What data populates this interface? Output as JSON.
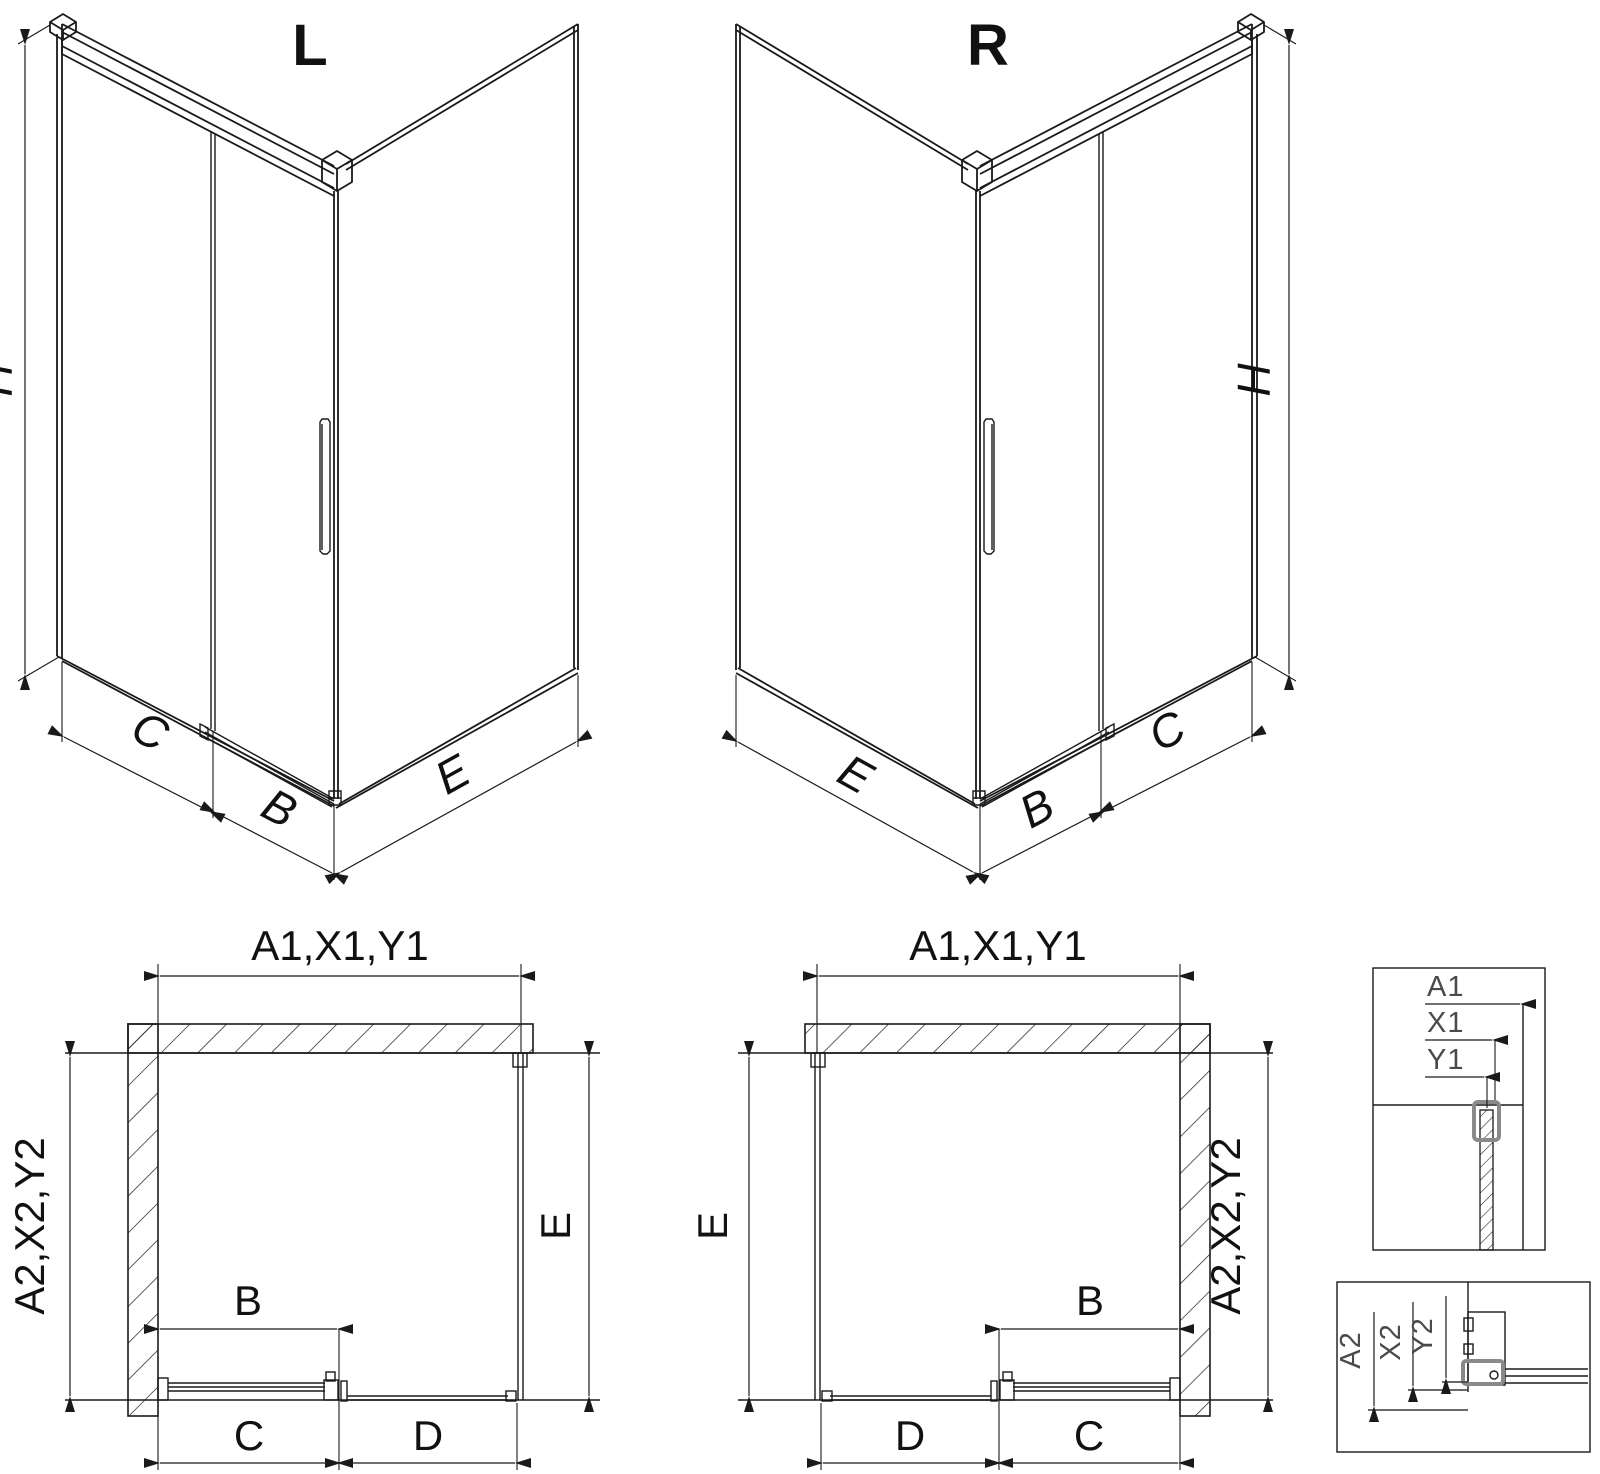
{
  "drawing": {
    "type": "shower-enclosure-technical-drawing",
    "background_color": "#ffffff",
    "line_color": "#1a1a1a",
    "detail_text_color": "#4a4a4a",
    "clamp_highlight_color": "#8a8a8a"
  },
  "iso_left": {
    "title": "L",
    "dim_height": "H",
    "dim_fixed_panel": "C",
    "dim_door": "B",
    "dim_return_panel": "E"
  },
  "iso_right": {
    "title": "R",
    "dim_height": "H",
    "dim_fixed_panel": "C",
    "dim_door": "B",
    "dim_return_panel": "E"
  },
  "plan_left": {
    "dim_top": "A1,X1,Y1",
    "dim_left_vertical": "A2,X2,Y2",
    "dim_right_vertical": "E",
    "dim_door": "B",
    "dim_bottom_left": "C",
    "dim_bottom_right": "D"
  },
  "plan_right": {
    "dim_top": "A1,X1,Y1",
    "dim_left_vertical": "E",
    "dim_right_vertical": "A2,X2,Y2",
    "dim_door": "B",
    "dim_bottom_left": "D",
    "dim_bottom_right": "C"
  },
  "detail_top": {
    "labels": [
      "A1",
      "X1",
      "Y1"
    ]
  },
  "detail_bottom": {
    "labels": [
      "A2",
      "X2",
      "Y2"
    ]
  }
}
